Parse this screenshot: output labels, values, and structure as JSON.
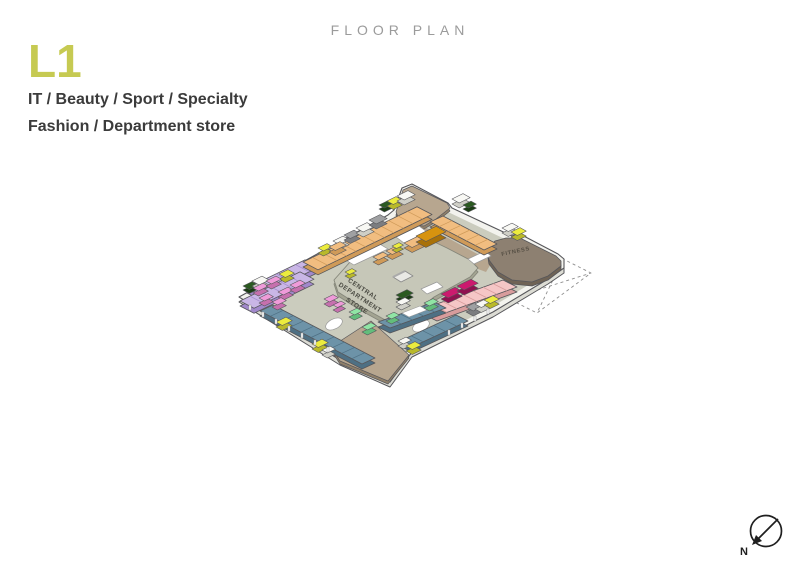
{
  "header": {
    "title": "FLOOR PLAN",
    "level": "L1",
    "category_line1": "IT / Beauty / Sport / Specialty",
    "category_line2": "Fashion / Department store"
  },
  "plan": {
    "central_label": [
      "CENTRAL",
      "DEPARTMENT",
      "STORE"
    ],
    "fitness_label": "FITNESS",
    "compass_n": "N"
  },
  "palette": {
    "accent": "#c6ca52",
    "title_gray": "#9b9b9b",
    "text_dark": "#3b3b3b",
    "outline": "#56565a",
    "slab_top": "#f3f3ee",
    "slab_side": "#dcdcd4",
    "corridor": "#cbccbe",
    "platform_top": "#c6c7b8",
    "platform_side": "#a3a492",
    "platform_line": "#85867a",
    "tan_top": "#b7a68f",
    "tan_side": "#8f7f69",
    "fitness_top": "#8d8071",
    "fitness_side": "#6f6355",
    "fitness_text": "#554e44",
    "central_text": "#4b4b43",
    "dash": "#8f8f8f",
    "void": "#ffffff",
    "orange": [
      "#f1bd80",
      "#cf9a58"
    ],
    "gold": [
      "#d7930f",
      "#a87109"
    ],
    "purple": [
      "#c9b6e6",
      "#a188cb"
    ],
    "orchid": [
      "#ef9bd9",
      "#c670ae"
    ],
    "pink": [
      "#f5c6c6",
      "#d89c9c"
    ],
    "magenta": [
      "#cb1a6e",
      "#8f1150"
    ],
    "slate": [
      "#6d93a8",
      "#4e7084"
    ],
    "lgreen": [
      "#90e5a5",
      "#62bd7b"
    ],
    "dgreen": [
      "#2b5a21",
      "#1b3d14"
    ],
    "yellow": [
      "#ecec3e",
      "#b9b92a"
    ],
    "white": [
      "#f8f8f4",
      "#cfcfc7"
    ],
    "gray": [
      "#9fa0a2",
      "#7c7d80"
    ],
    "compass": "#1f1f1f"
  }
}
